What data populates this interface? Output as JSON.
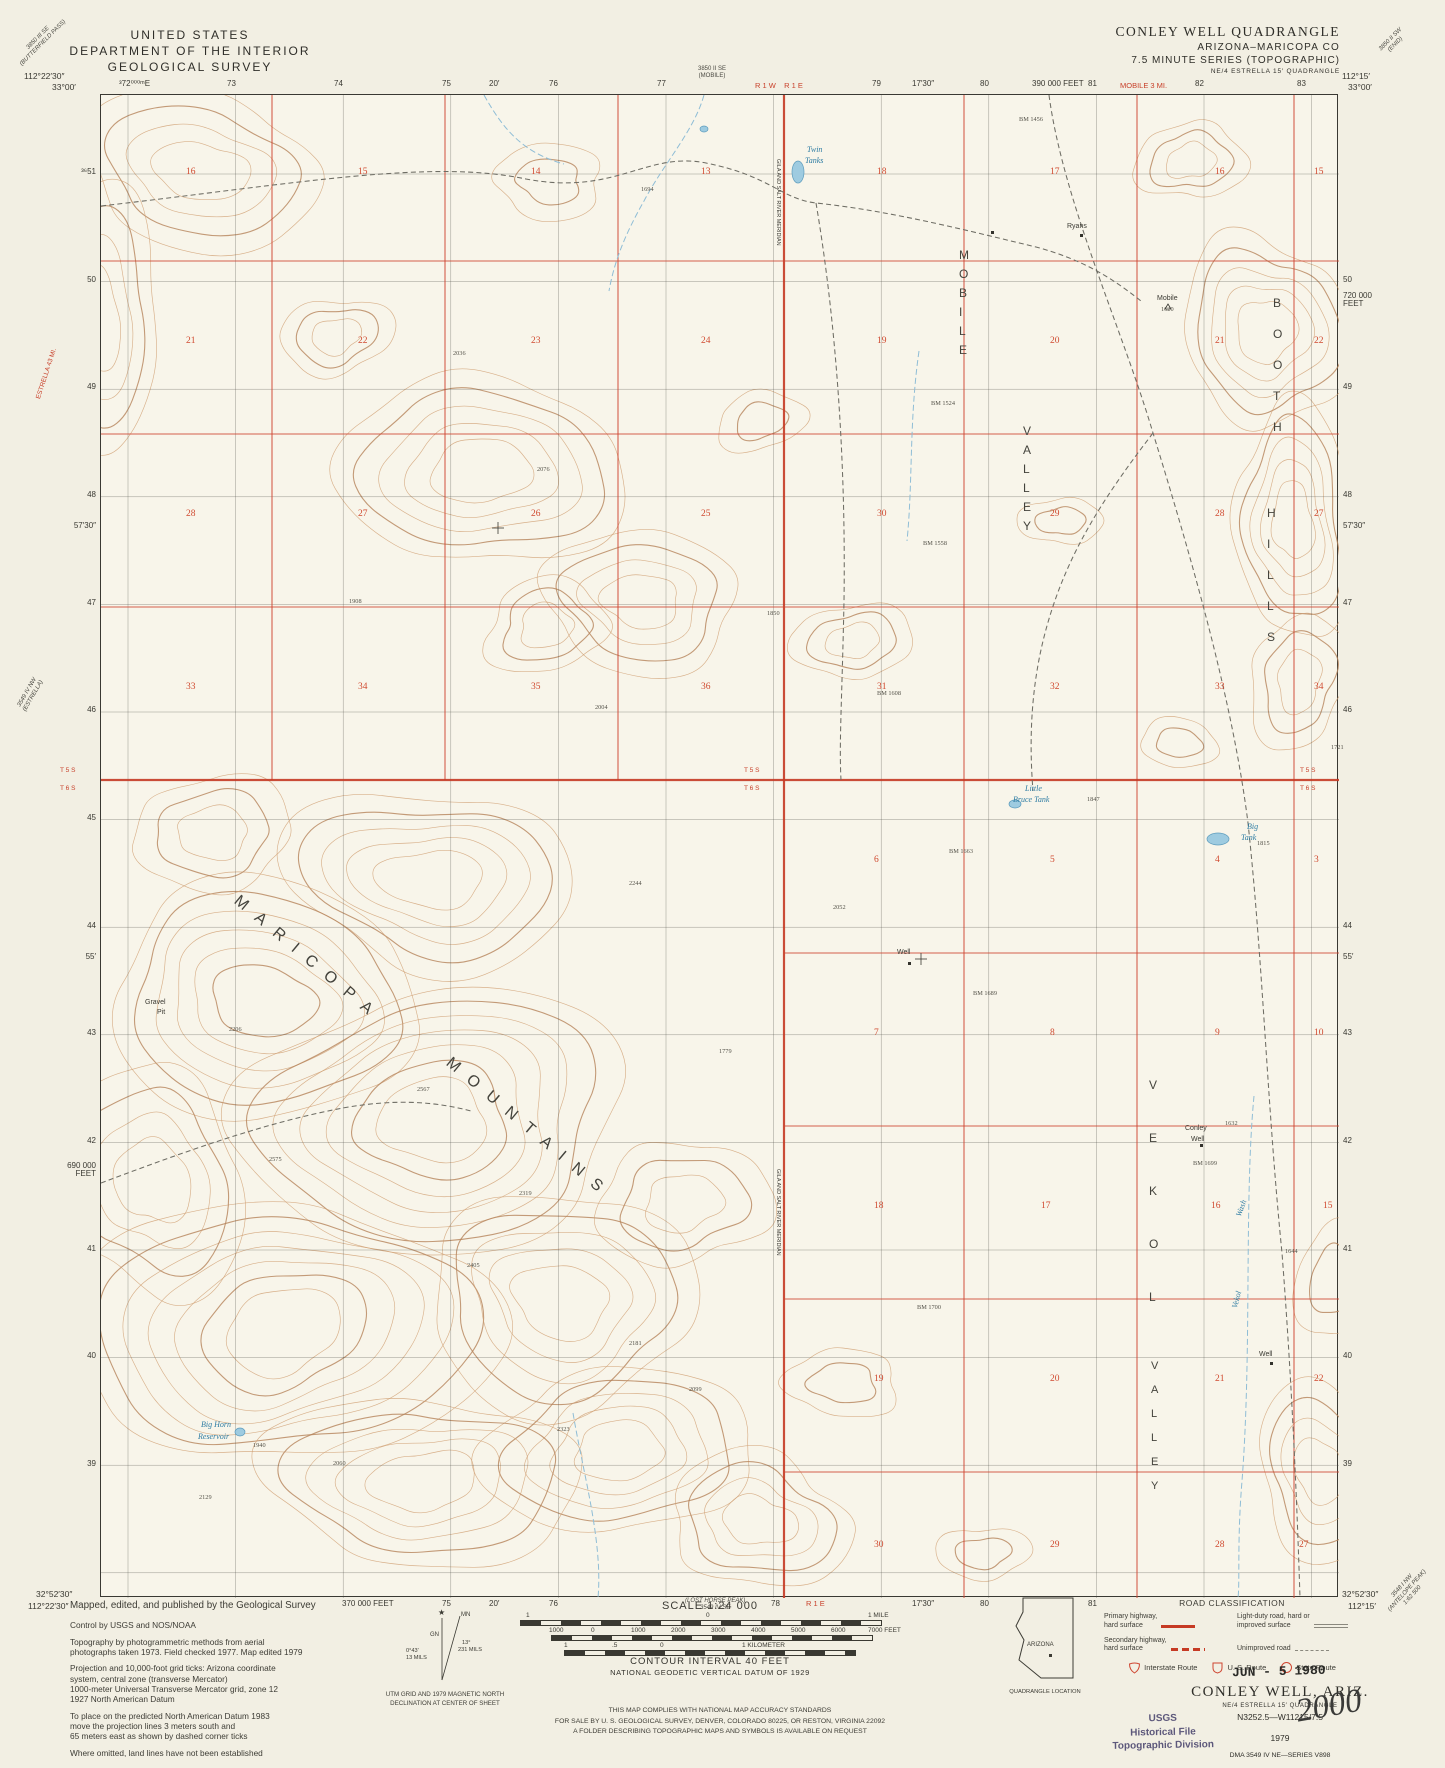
{
  "header": {
    "line1": "UNITED STATES",
    "line2": "DEPARTMENT OF THE INTERIOR",
    "line3": "GEOLOGICAL SURVEY"
  },
  "title_block": {
    "line1": "CONLEY WELL QUADRANGLE",
    "line2": "ARIZONA–MARICOPA CO",
    "line3": "7.5 MINUTE SERIES (TOPOGRAPHIC)",
    "line4": "NE/4 ESTRELLA 15′ QUADRANGLE"
  },
  "colors": {
    "red": "#c8402a",
    "blue": "#2e7ca3",
    "contour": "#c99a6b",
    "stamp_purple": "#4d4870"
  },
  "map": {
    "corners": [
      {
        "x": 24,
        "y": 72,
        "t": "112°22′30″",
        "align": "left"
      },
      {
        "x": 52,
        "y": 83,
        "t": "33°00′",
        "align": "left"
      },
      {
        "x": 1342,
        "y": 72,
        "t": "112°15′",
        "align": "left"
      },
      {
        "x": 1348,
        "y": 83,
        "t": "33°00′",
        "align": "left"
      },
      {
        "x": 36,
        "y": 1590,
        "t": "32°52′30″",
        "align": "left"
      },
      {
        "x": 28,
        "y": 1602,
        "t": "112°22′30″",
        "align": "left"
      },
      {
        "x": 1342,
        "y": 1590,
        "t": "32°52′30″",
        "align": "left"
      },
      {
        "x": 1348,
        "y": 1602,
        "t": "112°15′",
        "align": "left"
      }
    ],
    "top_ticks": [
      [
        127,
        "³72⁰⁰⁰ᵐE"
      ],
      [
        235,
        "73"
      ],
      [
        342,
        "74"
      ],
      [
        450,
        "75"
      ],
      [
        497,
        "20′"
      ],
      [
        557,
        "76"
      ],
      [
        665,
        "77"
      ],
      [
        880,
        "79"
      ],
      [
        920,
        "17′30″"
      ],
      [
        988,
        "80"
      ],
      [
        1040,
        "390 000 FEET"
      ],
      [
        1096,
        "81"
      ],
      [
        1203,
        "82"
      ],
      [
        1305,
        "83"
      ]
    ],
    "top_red": [
      [
        783,
        "R 1 W    R 1 E"
      ],
      [
        1148,
        "MOBILE 3 MI."
      ]
    ],
    "top_note": {
      "x": 718,
      "lines": [
        "3850 II SE",
        "(MOBILE)"
      ]
    },
    "bottom_ticks": [
      [
        350,
        "370 000 FEET"
      ],
      [
        450,
        "75"
      ],
      [
        497,
        "20′"
      ],
      [
        557,
        "76"
      ],
      [
        779,
        "78"
      ],
      [
        920,
        "17′30″"
      ],
      [
        988,
        "80"
      ],
      [
        1096,
        "81"
      ]
    ],
    "bottom_red": [
      [
        806,
        "R 1 E"
      ]
    ],
    "bottom_note": {
      "x": 713,
      "lines": [
        "(LOST HORSE PEAK)",
        "3549 IV SE"
      ]
    },
    "left_ticks": [
      [
        173,
        "³⁶51"
      ],
      [
        281,
        "50"
      ],
      [
        388,
        "49"
      ],
      [
        496,
        "48"
      ],
      [
        604,
        "47"
      ],
      [
        711,
        "46"
      ],
      [
        819,
        "45"
      ],
      [
        927,
        "44"
      ],
      [
        1034,
        "43"
      ],
      [
        1142,
        "42"
      ],
      [
        1250,
        "41"
      ],
      [
        1357,
        "40"
      ],
      [
        1465,
        "39"
      ],
      [
        527,
        "57′30″"
      ],
      [
        958,
        "55′"
      ]
    ],
    "left_feet": {
      "y": 1162,
      "lines": [
        "690 000",
        "FEET"
      ]
    },
    "right_ticks": [
      [
        281,
        "50"
      ],
      [
        388,
        "49"
      ],
      [
        496,
        "48"
      ],
      [
        604,
        "47"
      ],
      [
        711,
        "46"
      ],
      [
        927,
        "44"
      ],
      [
        1034,
        "43"
      ],
      [
        1142,
        "42"
      ],
      [
        1250,
        "41"
      ],
      [
        1357,
        "40"
      ],
      [
        1465,
        "39"
      ],
      [
        527,
        "57′30″"
      ],
      [
        958,
        "55′"
      ]
    ],
    "right_feet": {
      "y": 292,
      "lines": [
        "720 000",
        "FEET"
      ]
    },
    "township_labels": [
      [
        60,
        768,
        "T 5 S"
      ],
      [
        60,
        786,
        "T 6 S"
      ],
      [
        744,
        768,
        "T 5 S"
      ],
      [
        744,
        786,
        "T 6 S"
      ],
      [
        1300,
        768,
        "T 5 S"
      ],
      [
        1300,
        786,
        "T 6 S"
      ]
    ],
    "section_rows": [
      {
        "y": 172,
        "items": [
          [
            185,
            "16"
          ],
          [
            357,
            "15"
          ],
          [
            530,
            "14"
          ],
          [
            700,
            "13"
          ],
          [
            876,
            "18"
          ],
          [
            1049,
            "17"
          ],
          [
            1214,
            "16"
          ],
          [
            1313,
            "15"
          ]
        ]
      },
      {
        "y": 341,
        "items": [
          [
            185,
            "21"
          ],
          [
            357,
            "22"
          ],
          [
            530,
            "23"
          ],
          [
            700,
            "24"
          ],
          [
            876,
            "19"
          ],
          [
            1049,
            "20"
          ],
          [
            1214,
            "21"
          ],
          [
            1313,
            "22"
          ]
        ]
      },
      {
        "y": 514,
        "items": [
          [
            185,
            "28"
          ],
          [
            357,
            "27"
          ],
          [
            530,
            "26"
          ],
          [
            700,
            "25"
          ],
          [
            876,
            "30"
          ],
          [
            1049,
            "29"
          ],
          [
            1214,
            "28"
          ],
          [
            1313,
            "27"
          ]
        ]
      },
      {
        "y": 687,
        "items": [
          [
            185,
            "33"
          ],
          [
            357,
            "34"
          ],
          [
            530,
            "35"
          ],
          [
            700,
            "36"
          ],
          [
            876,
            "31"
          ],
          [
            1049,
            "32"
          ],
          [
            1214,
            "33"
          ],
          [
            1313,
            "34"
          ]
        ]
      },
      {
        "y": 860,
        "items": [
          [
            873,
            "6"
          ],
          [
            1049,
            "5"
          ],
          [
            1214,
            "4"
          ],
          [
            1313,
            "3"
          ]
        ]
      },
      {
        "y": 1033,
        "items": [
          [
            873,
            "7"
          ],
          [
            1049,
            "8"
          ],
          [
            1214,
            "9"
          ],
          [
            1313,
            "10"
          ]
        ]
      },
      {
        "y": 1206,
        "items": [
          [
            873,
            "18"
          ],
          [
            1040,
            "17"
          ],
          [
            1210,
            "16"
          ],
          [
            1322,
            "15"
          ]
        ]
      },
      {
        "y": 1379,
        "items": [
          [
            873,
            "19"
          ],
          [
            1049,
            "20"
          ],
          [
            1214,
            "21"
          ],
          [
            1313,
            "22"
          ]
        ]
      },
      {
        "y": 1545,
        "items": [
          [
            873,
            "30"
          ],
          [
            1049,
            "29"
          ],
          [
            1214,
            "28"
          ],
          [
            1298,
            "27"
          ]
        ]
      }
    ],
    "big_labels": [
      {
        "text": "MARICOPA",
        "x": 240,
        "y": 892,
        "rot": 40,
        "ls": 13,
        "fs": 16
      },
      {
        "text": "MOUNTAINS",
        "x": 452,
        "y": 1054,
        "rot": 40,
        "ls": 13,
        "fs": 16
      },
      {
        "text": "MOBILE",
        "x": 958,
        "y": 248,
        "step": 19,
        "fs": 12
      },
      {
        "text": "VALLEY",
        "x": 1022,
        "y": 424,
        "step": 19,
        "fs": 12
      },
      {
        "text": "BOOTH",
        "x": 1272,
        "y": 296,
        "step": 31,
        "fs": 12
      },
      {
        "text": "HILLS",
        "x": 1266,
        "y": 506,
        "step": 31,
        "fs": 12
      },
      {
        "text": "VEKOL",
        "x": 1148,
        "y": 1078,
        "step": 53,
        "fs": 12
      },
      {
        "text": "VALLEY",
        "x": 1150,
        "y": 1360,
        "step": 24,
        "fs": 11
      }
    ],
    "water_labels": [
      {
        "t": "Twin",
        "x": 806,
        "y": 145
      },
      {
        "t": "Tanks",
        "x": 804,
        "y": 156
      },
      {
        "t": "Little",
        "x": 1024,
        "y": 784
      },
      {
        "t": "Bruce Tank",
        "x": 1012,
        "y": 795
      },
      {
        "t": "Big",
        "x": 1246,
        "y": 822
      },
      {
        "t": "Tank",
        "x": 1240,
        "y": 833
      },
      {
        "t": "Big Horn",
        "x": 200,
        "y": 1420
      },
      {
        "t": "Reservoir",
        "x": 197,
        "y": 1432
      },
      {
        "t": "Wash",
        "x": 1234,
        "y": 1214,
        "rot": -70
      },
      {
        "t": "Vekol",
        "x": 1230,
        "y": 1306,
        "rot": -75
      }
    ],
    "feature_labels": [
      {
        "t": "Ryans",
        "x": 1066,
        "y": 222
      },
      {
        "t": "Mobile",
        "x": 1156,
        "y": 294
      },
      {
        "t": "Gravel",
        "x": 144,
        "y": 998
      },
      {
        "t": "Pit",
        "x": 156,
        "y": 1008
      },
      {
        "t": "Well",
        "x": 896,
        "y": 948
      },
      {
        "t": "Conley",
        "x": 1184,
        "y": 1124
      },
      {
        "t": "Well",
        "x": 1190,
        "y": 1135
      },
      {
        "t": "Well",
        "x": 1258,
        "y": 1350
      },
      {
        "t": "GILA AND SALT RIVER MERIDIAN",
        "x": 779,
        "y": 158,
        "rot": 90,
        "fs": 5.5
      },
      {
        "t": "GILA AND SALT RIVER MERIDIAN",
        "x": 779,
        "y": 1168,
        "rot": 90,
        "fs": 5.5
      }
    ],
    "spot_elevations": [
      [
        640,
        186,
        "1694"
      ],
      [
        1018,
        116,
        "BM 1456"
      ],
      [
        930,
        400,
        "BM 1524"
      ],
      [
        922,
        540,
        "BM 1558"
      ],
      [
        876,
        690,
        "BM 1608"
      ],
      [
        948,
        848,
        "BM 1663"
      ],
      [
        972,
        990,
        "BM 1689"
      ],
      [
        1192,
        1160,
        "BM 1699"
      ],
      [
        916,
        1304,
        "BM 1700"
      ],
      [
        594,
        704,
        "2004"
      ],
      [
        628,
        880,
        "2244"
      ],
      [
        832,
        904,
        "2052"
      ],
      [
        766,
        610,
        "1850"
      ],
      [
        536,
        466,
        "2076"
      ],
      [
        228,
        1026,
        "2206"
      ],
      [
        416,
        1086,
        "2567"
      ],
      [
        518,
        1190,
        "2319"
      ],
      [
        268,
        1156,
        "2575"
      ],
      [
        466,
        1262,
        "2405"
      ],
      [
        628,
        1340,
        "2181"
      ],
      [
        556,
        1426,
        "2323"
      ],
      [
        688,
        1386,
        "2099"
      ],
      [
        252,
        1442,
        "1940"
      ],
      [
        332,
        1460,
        "2060"
      ],
      [
        198,
        1494,
        "2129"
      ],
      [
        1086,
        796,
        "1847"
      ],
      [
        1256,
        840,
        "1815"
      ],
      [
        1330,
        744,
        "1721"
      ],
      [
        1224,
        1120,
        "1632"
      ],
      [
        1284,
        1248,
        "1644"
      ],
      [
        452,
        350,
        "2036"
      ],
      [
        348,
        598,
        "1908"
      ],
      [
        1160,
        306,
        "1620"
      ],
      [
        718,
        1048,
        "1779"
      ]
    ],
    "diag_notes": [
      {
        "x": 14,
        "y": 58,
        "rot": -45,
        "lines": [
          "3850 III SE",
          "(BUTTERFIELD PASS)"
        ]
      },
      {
        "x": 1378,
        "y": 48,
        "rot": -45,
        "lines": [
          "3850 II SW",
          "(ENID)"
        ]
      },
      {
        "x": 16,
        "y": 706,
        "rot": -60,
        "lines": [
          "3549 IV NW",
          "(ESTRELLA)"
        ]
      },
      {
        "x": 1382,
        "y": 1604,
        "rot": -48,
        "lines": [
          "3548 I NW",
          "(ANTELOPE PEAK)",
          "1:62 500"
        ]
      }
    ],
    "red_diag": {
      "t": "ESTRELLA 43 MI.",
      "x": 36,
      "y": 398,
      "rot": -72
    }
  },
  "footer": {
    "credits": [
      "Mapped, edited, and published by the Geological Survey",
      "Control by USGS and NOS/NOAA",
      "Topography by photogrammetric methods from aerial\nphotographs taken 1973.  Field checked 1977.  Map edited 1979",
      "Projection and 10,000-foot grid ticks: Arizona coordinate\nsystem, central zone (transverse Mercator)\n1000-meter Universal Transverse Mercator grid, zone 12\n1927 North American Datum",
      "To place on the predicted North American Datum 1983\nmove the projection lines 3 meters south and\n65 meters east as shown by dashed corner ticks",
      "Where omitted, land lines have not been established"
    ],
    "scale": {
      "heading": "SCALE 1:24 000",
      "mile_labels": [
        [
          526,
          "1"
        ],
        [
          706,
          "0"
        ],
        [
          868,
          "1 MILE"
        ]
      ],
      "feet_labels": [
        [
          549,
          "1000"
        ],
        [
          591,
          "0"
        ],
        [
          631,
          "1000"
        ],
        [
          671,
          "2000"
        ],
        [
          711,
          "3000"
        ],
        [
          751,
          "4000"
        ],
        [
          791,
          "5000"
        ],
        [
          831,
          "6000"
        ],
        [
          868,
          "7000 FEET"
        ]
      ],
      "km_labels": [
        [
          564,
          "1"
        ],
        [
          612,
          ".5"
        ],
        [
          660,
          "0"
        ],
        [
          742,
          "1 KILOMETER"
        ]
      ],
      "contour_note": "CONTOUR INTERVAL 40 FEET",
      "datum_note": "NATIONAL GEODETIC VERTICAL DATUM OF 1929"
    },
    "declination": {
      "gn": "GN",
      "mn": "MN",
      "left_deg": "0°43′",
      "left_mils": "13 MILS",
      "right_deg": "13°",
      "right_mils": "231 MILS",
      "caption1": "UTM GRID AND 1979 MAGNETIC NORTH",
      "caption2": "DECLINATION AT CENTER OF SHEET"
    },
    "compliance": [
      "THIS MAP COMPLIES WITH NATIONAL MAP ACCURACY STANDARDS",
      "FOR SALE BY U. S. GEOLOGICAL SURVEY, DENVER, COLORADO 80225, OR RESTON, VIRGINIA 22092",
      "A FOLDER DESCRIBING TOPOGRAPHIC MAPS AND SYMBOLS IS AVAILABLE ON REQUEST"
    ],
    "road_classification": {
      "title": "ROAD CLASSIFICATION",
      "items": [
        {
          "label": "Primary highway,\nhard surface",
          "style": "primary"
        },
        {
          "label": "Light-duty road, hard or\nimproved surface",
          "style": "light"
        },
        {
          "label": "Secondary highway,\nhard surface",
          "style": "secondary"
        },
        {
          "label": "Unimproved road",
          "style": "unimproved"
        }
      ],
      "routes": [
        "Interstate Route",
        "U. S. Route",
        "State Route"
      ]
    },
    "publication": {
      "title": "CONLEY WELL, ARIZ.",
      "subtitle": "NE/4 ESTRELLA 15′ QUADRANGLE",
      "code": "N3252.5—W11215/7.5",
      "year": "1979",
      "dma": "DMA 3549 IV NE—SERIES V898"
    },
    "stamps": {
      "date": "JUN - 5 1980",
      "usgs": [
        "USGS",
        "Historical File",
        "Topographic Division"
      ],
      "handwritten": "2000"
    },
    "quad_location": {
      "state": "ARIZONA",
      "caption": "QUADRANGLE LOCATION"
    }
  }
}
